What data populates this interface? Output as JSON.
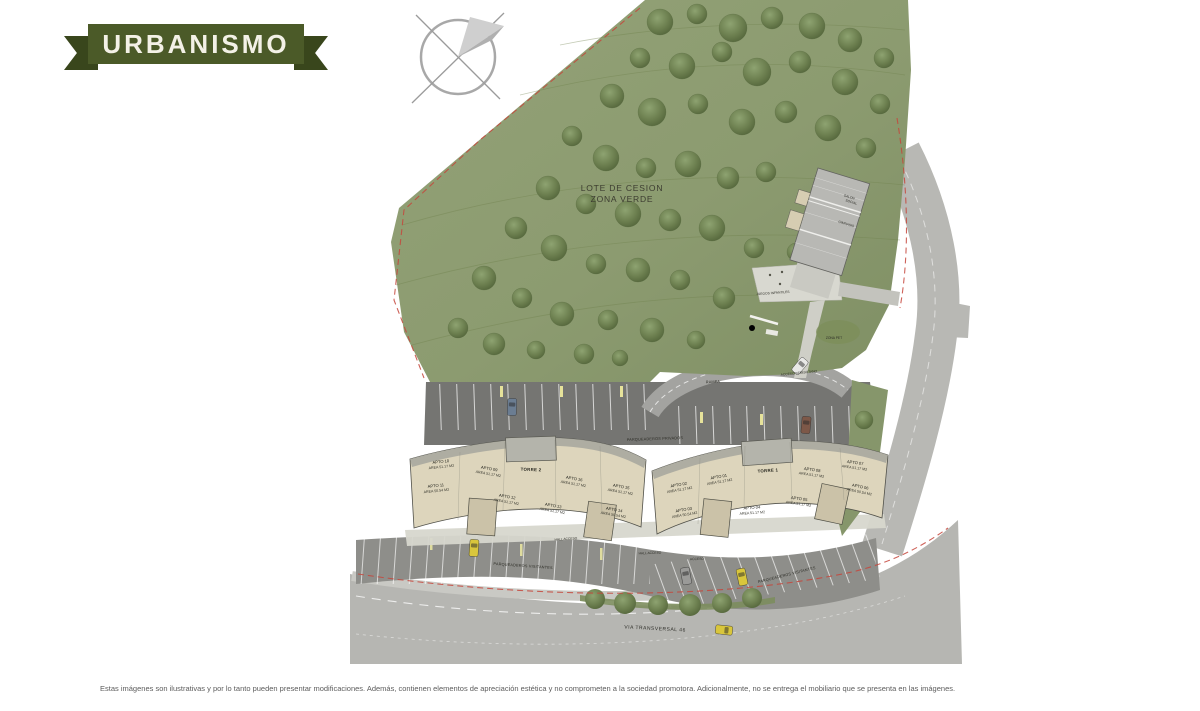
{
  "banner": {
    "label": "URBANISMO"
  },
  "colors": {
    "banner_green": "#4b5a28",
    "banner_tail_green": "#39461c",
    "grass": "#8c9b70",
    "road_gray": "#b6b6b2",
    "deck_gray": "#757572",
    "building_beige": "#ddd5bc",
    "boundary_red": "#c5473c"
  },
  "plan": {
    "zone": {
      "line1": "LOTE DE CESION",
      "line2": "ZONA VERDE"
    },
    "amenity": {
      "salon_line1": "SALON",
      "salon_line2": "SOCIAL",
      "gimnasio": "GIMNASIO"
    },
    "areas": {
      "juegos": "JUEGOS INFANTILES",
      "zona_pet": "ZONA PET"
    },
    "circulation": {
      "rampa": "RAMPA",
      "acceso_semisotano": "ACCESO SEMISOTANO",
      "parqueaderos_privados": "PARQUEADEROS PRIVADOS",
      "parqueaderos_visitantes_left": "PARQUEADEROS VISITANTES",
      "parqueaderos_visitantes_right": "PARQUEADEROS VISITANTES",
      "hall_acceso_left": "HALL ACCESO",
      "hall_acceso_center": "HALL ACCESO",
      "acceso": "ACCESO",
      "via_transversal": "VIA TRANSVERSAL 46"
    },
    "torre_2": {
      "name": "TORRE 2",
      "apartments": [
        {
          "label": "APTO 10",
          "area": "AREA 51.17 M2"
        },
        {
          "label": "APTO 09",
          "area": "AREA 51.17 M2"
        },
        {
          "label": "APTO 16",
          "area": "AREA 51.17 M2"
        },
        {
          "label": "APTO 15",
          "area": "AREA 51.17 M2"
        },
        {
          "label": "APTO 11",
          "area": "AREA 50.54 M2"
        },
        {
          "label": "APTO 12",
          "area": "AREA 51.17 M2"
        },
        {
          "label": "APTO 13",
          "area": "AREA 51.17 M2"
        },
        {
          "label": "APTO 14",
          "area": "AREA 50.54 M2"
        }
      ]
    },
    "torre_1": {
      "name": "TORRE 1",
      "apartments": [
        {
          "label": "APTO 02",
          "area": "AREA 51.17 M2"
        },
        {
          "label": "APTO 01",
          "area": "AREA 51.17 M2"
        },
        {
          "label": "APTO 08",
          "area": "AREA 51.17 M2"
        },
        {
          "label": "APTO 07",
          "area": "AREA 51.17 M2"
        },
        {
          "label": "APTO 03",
          "area": "AREA 50.54 M2"
        },
        {
          "label": "APTO 04",
          "area": "AREA 51.17 M2"
        },
        {
          "label": "APTO 05",
          "area": "AREA 51.17 M2"
        },
        {
          "label": "APTO 06",
          "area": "AREA 50.54 M2"
        }
      ]
    }
  },
  "footer": {
    "disclaimer": "Estas imágenes son ilustrativas y por lo tanto pueden presentar modificaciones. Además, contienen elementos de apreciación estética y no comprometen a la sociedad promotora. Adicionalmente, no se entrega el mobiliario que se presenta en las imágenes."
  }
}
